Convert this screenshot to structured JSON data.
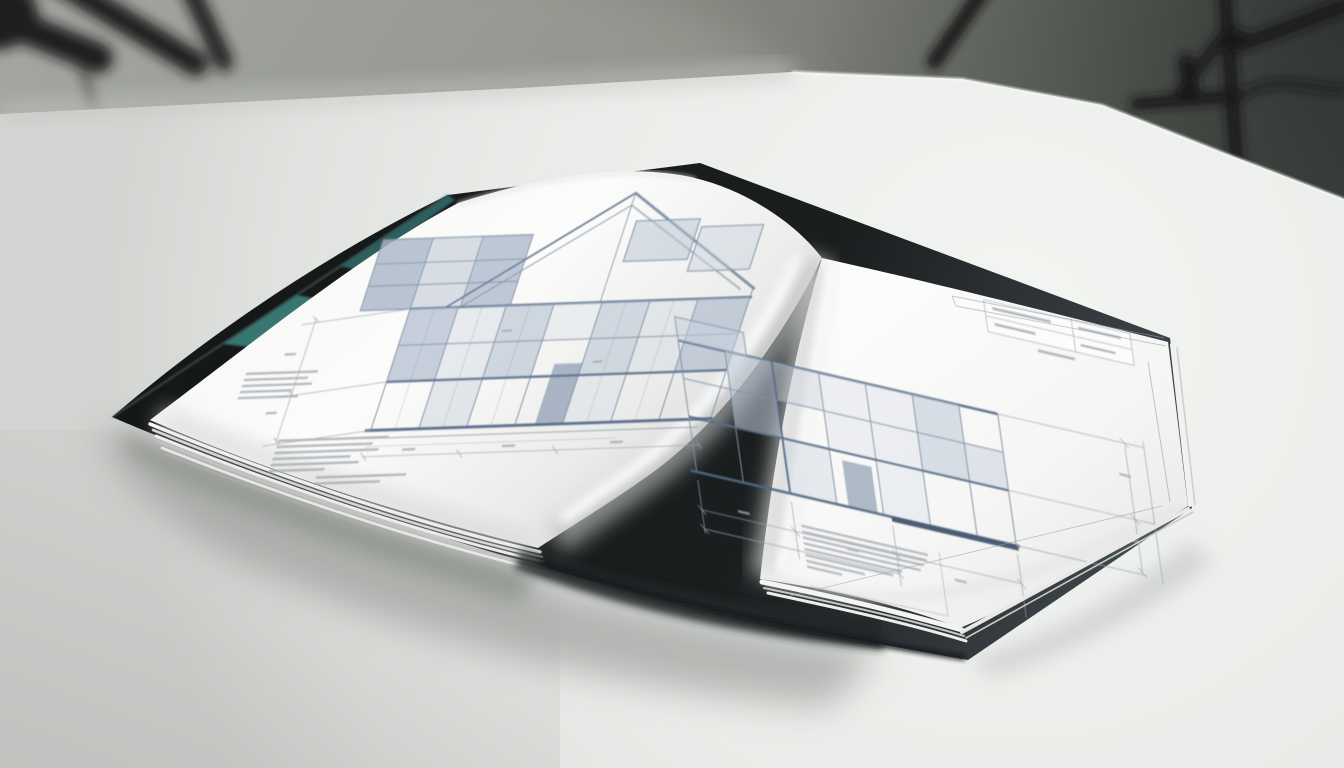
{
  "scene": {
    "setting": "photo-studio-backdrop",
    "subject": "open-hardcover-architecture-book",
    "left_page": "building-elevation-gable-roof-blueprint",
    "right_page": "dimensioned-building-elevation-blueprint",
    "background_props": [
      "tripod-left",
      "tripod-right",
      "stand-cable"
    ],
    "surface": "white-seamless-table"
  },
  "colors": {
    "wall_light": "#999c98",
    "wall_mid": "#84877f",
    "wall_dark": "#3f433f",
    "table_bright": "#f3f5f2",
    "table_mid": "#eaece9",
    "table_dim": "#d3d5d2",
    "tripod_black": "#131516",
    "cover_black": "#141718",
    "cover_edge_gray": "#434b4f",
    "accent_teal_bright": "#37766f",
    "accent_teal_deep": "#2d5f5e",
    "page_white": "#fcfcfb",
    "page_shade": "#d8dad8",
    "drawing_line": "#8292a6",
    "drawing_line_bold": "#5a6f8c",
    "drawing_panel": "#b5c1d1",
    "dimension_line": "#99a3ad",
    "annotation_gray": "#a3a9b0",
    "shadow_soft": "#90938f"
  }
}
